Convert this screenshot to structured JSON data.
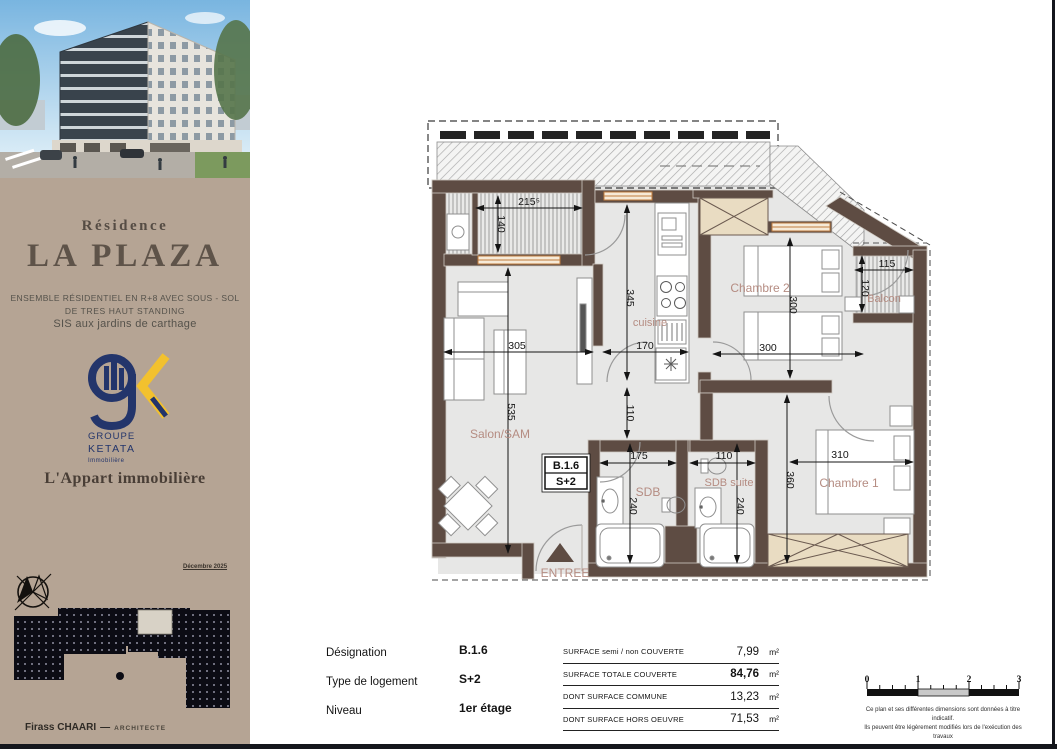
{
  "sidebar": {
    "residence": "Résidence",
    "name": "LA PLAZA",
    "sub1": "ENSEMBLE  RÉSIDENTIEL EN R+8 AVEC SOUS - SOL",
    "sub2": "DE TRES HAUT STANDING",
    "sub3": "SIS aux jardins de carthage",
    "logo": {
      "l1": "GROUPE",
      "l2": "KETATA",
      "l3": "Immobilière"
    },
    "brand": "L'Appart immobilière",
    "date": "Décembre 2025",
    "architect": {
      "name": "Firass CHAARI",
      "dash": "—",
      "title": "ARCHITECTE"
    }
  },
  "plan": {
    "unit": {
      "code": "B.1.6",
      "type": "S+2"
    },
    "rooms": {
      "salon": "Salon/SAM",
      "cuisine": "cuisine",
      "chambre2": "Chambre 2",
      "chambre1": "Chambre 1",
      "balcon": "Balcon",
      "sdb": "SDB",
      "sdb_suite": "SDB suite",
      "entree": "ENTREE"
    },
    "dims": {
      "t215": "215⁵",
      "t140": "140",
      "t345": "345",
      "t305": "305",
      "t170": "170",
      "h300": "300",
      "v300": "300",
      "t535": "535",
      "t110": "110",
      "t115": "115",
      "t120": "120",
      "t175": "175",
      "b110": "110",
      "a240": "240",
      "b240": "240",
      "t360": "360",
      "t310": "310"
    }
  },
  "info_table": {
    "rows": [
      {
        "label": "Désignation",
        "value": "B.1.6"
      },
      {
        "label": "Type de logement",
        "value": "S+2"
      },
      {
        "label": "Niveau",
        "value": "1er étage"
      }
    ]
  },
  "surface_table": {
    "rows": [
      {
        "label": "SURFACE semi / non COUVERTE",
        "value": "7,99",
        "unit": "m²"
      },
      {
        "label": "SURFACE TOTALE COUVERTE",
        "value": "84,76",
        "unit": "m²"
      },
      {
        "label": "DONT SURFACE COMMUNE",
        "value": "13,23",
        "unit": "m²"
      },
      {
        "label": "DONT SURFACE  HORS OEUVRE",
        "value": "71,53",
        "unit": "m²"
      }
    ]
  },
  "scalebar": {
    "labels": [
      "0",
      "1",
      "2",
      "3"
    ],
    "note1": "Ce plan et ses différentes dimensions sont données à titre indicatif.",
    "note2": "Ils peuvent être légèrement modifiés lors de l'exécution des travaux"
  },
  "colors": {
    "sidebar_bg": "#b5a494",
    "wall": "#5e4c43",
    "room_label": "#b58c82",
    "window": "#c07c3e",
    "logo_navy": "#23356b",
    "logo_yellow": "#f2c12e",
    "floor": "#e7e7e6"
  }
}
